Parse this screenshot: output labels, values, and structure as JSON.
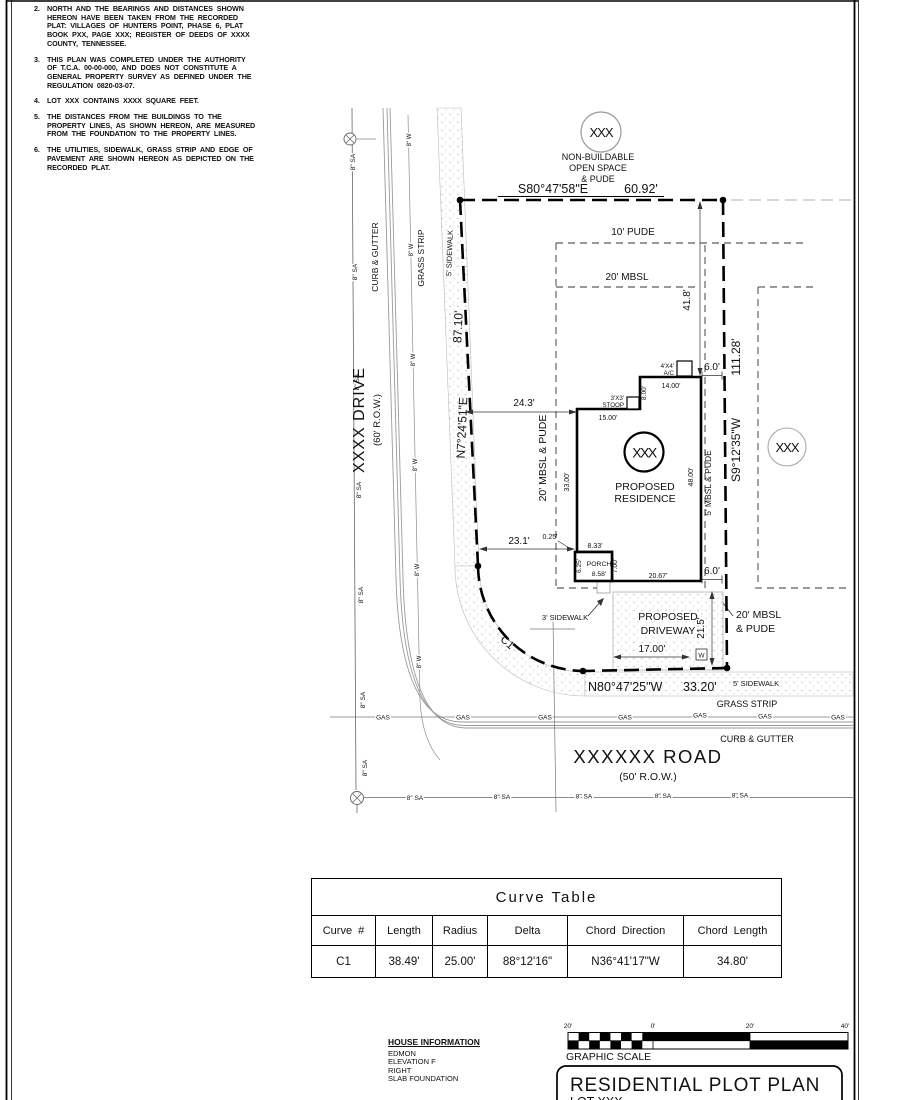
{
  "colors": {
    "ink": "#111111",
    "line_gray": "#8a8a8a",
    "stipple_dot": "#bdbdbd"
  },
  "notes": {
    "items": [
      {
        "num": "2.",
        "text": "NORTH AND THE BEARINGS AND DISTANCES SHOWN HEREON HAVE BEEN TAKEN FROM THE RECORDED PLAT: VILLAGES OF HUNTERS POINT, PHASE 6, PLAT BOOK PXX, PAGE XXX; REGISTER OF DEEDS OF XXXX COUNTY, TENNESSEE."
      },
      {
        "num": "3.",
        "text": "THIS PLAN WAS COMPLETED UNDER THE AUTHORITY OF T.C.A. 00-00-000, AND DOES NOT CONSTITUTE A GENERAL PROPERTY SURVEY AS DEFINED UNDER THE REGULATION 0820-03-07."
      },
      {
        "num": "4.",
        "text": "LOT XXX CONTAINS XXXX SQUARE FEET."
      },
      {
        "num": "5.",
        "text": "THE DISTANCES FROM THE BUILDINGS TO THE PROPERTY LINES, AS SHOWN HEREON, ARE MEASURED FROM THE FOUNDATION TO THE PROPERTY LINES."
      },
      {
        "num": "6.",
        "text": "THE UTILITIES, SIDEWALK, GRASS STRIP AND EDGE OF PAVEMENT ARE SHOWN HEREON AS DEPICTED ON THE RECORDED PLAT."
      }
    ]
  },
  "plan": {
    "open_space": {
      "lot": "XXX",
      "l1": "NON-BUILDABLE",
      "l2": "OPEN SPACE",
      "l3": "& PUDE"
    },
    "adjacent_lot": "XXX",
    "bearings": {
      "north": "S80°47'58\"E",
      "north_len": "60.92'",
      "west": "N7°24'51\"E",
      "west_len": "87.10'",
      "east": "S9°12'35\"W",
      "east_len": "111.28'",
      "south": "N80°47'25\"W",
      "south_len": "33.20'"
    },
    "curve_label": "C1",
    "streets": {
      "west": {
        "name": "XXXX DRIVE",
        "row": "(60' R.O.W.)",
        "curb": "CURB & GUTTER",
        "grass": "GRASS STRIP",
        "sidewalk": "5' SIDEWALK"
      },
      "south": {
        "name": "XXXXXX ROAD",
        "row": "(50' R.O.W.)",
        "curb": "CURB & GUTTER",
        "grass": "GRASS STRIP",
        "sidewalk": "5' SIDEWALK"
      }
    },
    "utilities": {
      "sa": "8\" SA",
      "w": "8\" W",
      "gas": "GAS",
      "water_meter": "W"
    },
    "setbacks": {
      "pude10": "10' PUDE",
      "mbsl20": "20' MBSL",
      "front_l1": "20' MBSL",
      "front_l2": "& PUDE",
      "west": "20' MBSL & PUDE",
      "side": "5' MBSL & PUDE"
    },
    "residence": {
      "lot": "XXX",
      "l1": "PROPOSED",
      "l2": "RESIDENCE",
      "porch": "PORCH",
      "stoop_l1": "3'X3'",
      "stoop_l2": "STOOP",
      "ac_l1": "4'X4'",
      "ac_l2": "A/C"
    },
    "driveway": {
      "l1": "PROPOSED",
      "l2": "DRIVEWAY"
    },
    "walk_label": "3' SIDEWALK",
    "dims": {
      "d24_3": "24.3'",
      "d23_1": "23.1'",
      "d0_25": "0.25'",
      "d41_8": "41.8'",
      "d6_0": "6.0'",
      "d14_00": "14.00'",
      "d8_00": "8.00'",
      "d15_00": "15.00'",
      "d33_00": "33.00'",
      "d48_00": "48.00'",
      "d20_67": "20.67'",
      "d8_33": "8.33'",
      "d6_25": "6.25'",
      "d8_58": "8.58'",
      "d7_00": "7.00'",
      "d17_00": "17.00'",
      "d21_5": "21.5'"
    }
  },
  "curve_table": {
    "title": "Curve Table",
    "headers": [
      "Curve #",
      "Length",
      "Radius",
      "Delta",
      "Chord Direction",
      "Chord Length"
    ],
    "rows": [
      [
        "C1",
        "38.49'",
        "25.00'",
        "88°12'16\"",
        "N36°41'17\"W",
        "34.80'"
      ]
    ]
  },
  "house_info": {
    "title": "HOUSE INFORMATION",
    "lines": [
      "EDMON",
      "ELEVATION F",
      "RIGHT",
      "SLAB FOUNDATION"
    ]
  },
  "scale": {
    "labels": [
      "20'",
      "0'",
      "20'",
      "40'"
    ],
    "caption": "GRAPHIC SCALE"
  },
  "title_block": {
    "title": "RESIDENTIAL PLOT PLAN",
    "lot": "LOT XXX"
  }
}
